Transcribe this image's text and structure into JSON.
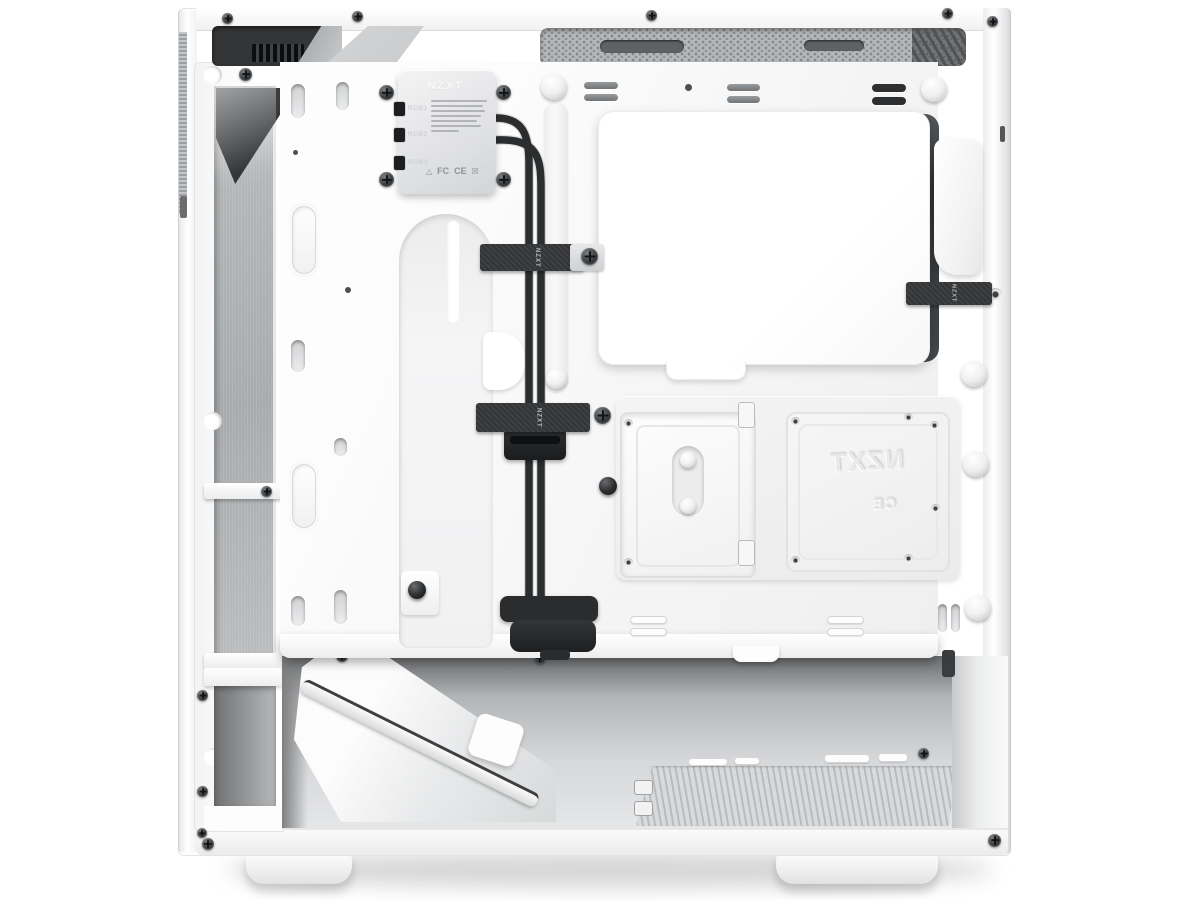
{
  "scene": {
    "alt": "White NZXT mid-tower PC case seen from the open right side with the panel removed, showing the cable-management channel, RGB controller, velcro straps, SSD tray and empty PSU bay"
  },
  "controller": {
    "brand": "NZXT",
    "ports": [
      "RGB1",
      "RGB2",
      "RGB3"
    ],
    "cert_marks": [
      "FC",
      "CE"
    ],
    "icons": {
      "recycle": "△",
      "weee": "☒"
    }
  },
  "labels": {
    "strap": "NZXT"
  },
  "embossed_tray": {
    "brand": "NZXT",
    "cert": "CE"
  },
  "colors": {
    "background": "#ffffff",
    "case_white": "#f7f7f8",
    "mesh_gray": "#b4b7b9",
    "chamber_gray": "#c3c5c7",
    "cable_black": "#2b2d2f",
    "strap_black": "#323436"
  }
}
